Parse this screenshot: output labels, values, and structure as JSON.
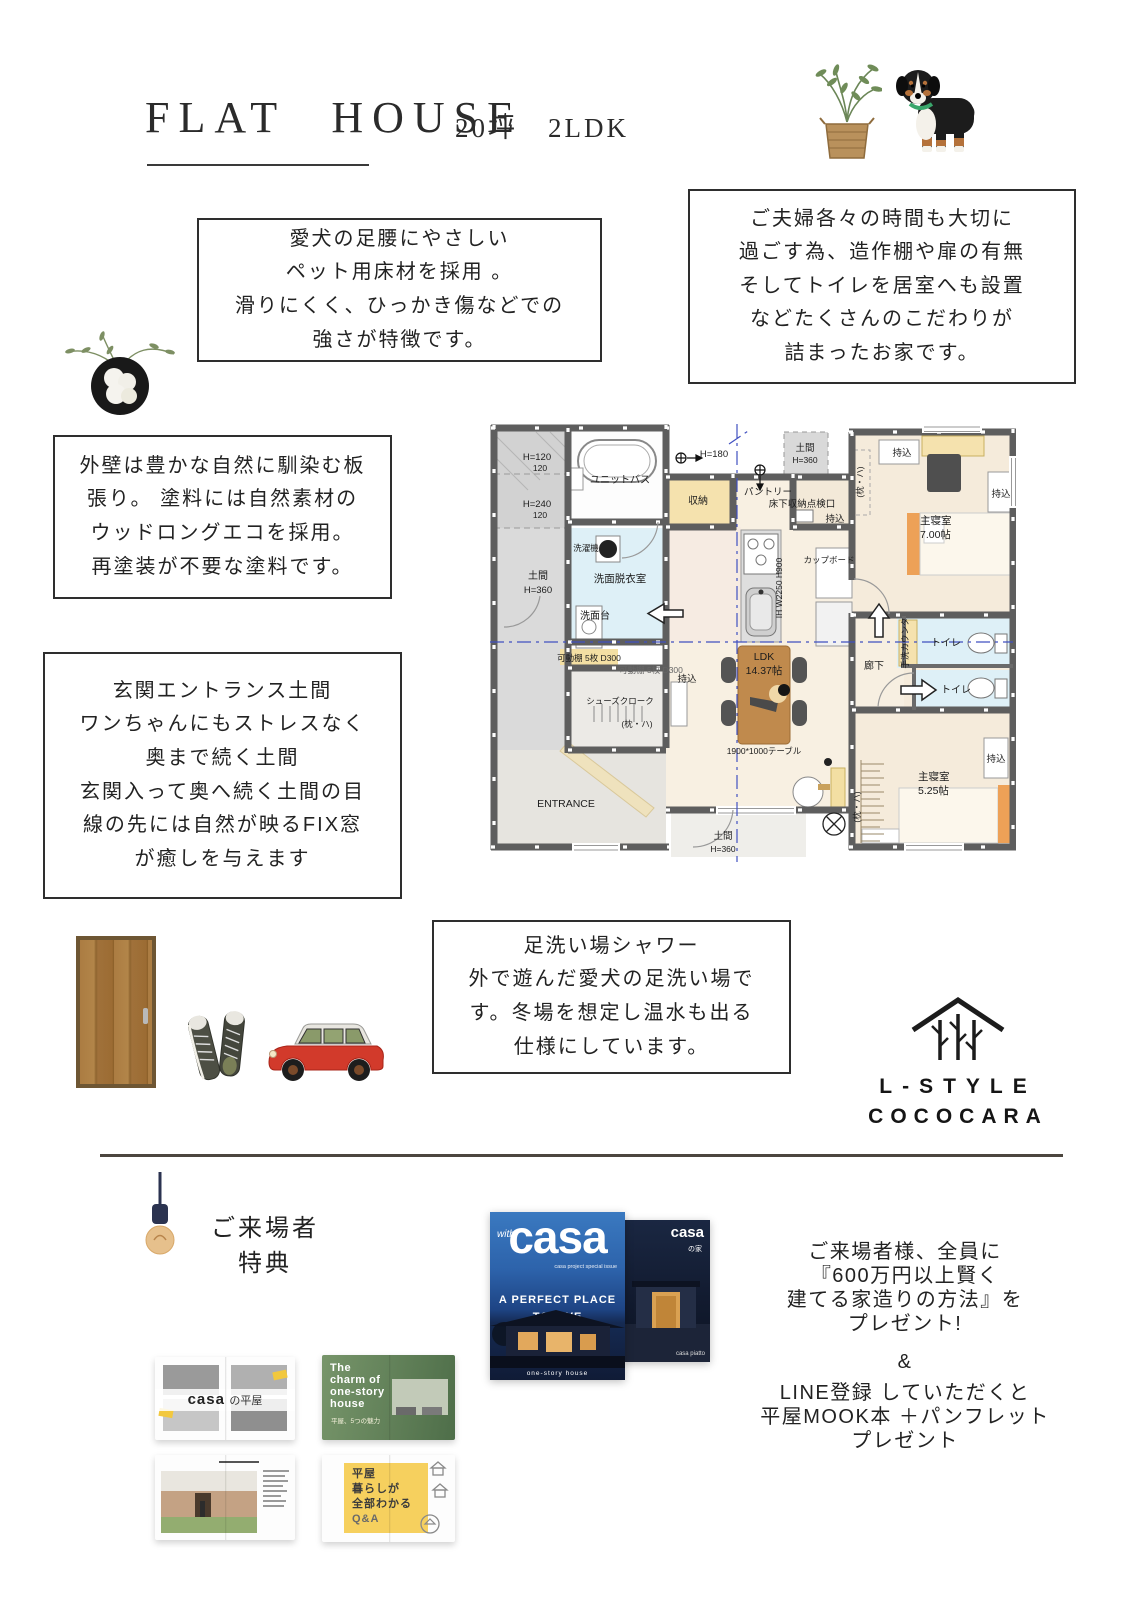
{
  "header": {
    "title": "FLAT HOUSE",
    "subtitle": "20坪　2LDK"
  },
  "boxes": {
    "pet": [
      "愛犬の足腰にやさしい",
      "ペット用床材を採用 。",
      "滑りにくく、ひっかき傷などでの",
      "強さが特徴です。"
    ],
    "couple": [
      "ご夫婦各々の時間も大切に",
      "過ごす為、造作棚や扉の有無",
      "そしてトイレを居室へも設置",
      "などたくさんのこだわりが",
      "詰まったお家です。"
    ],
    "wall": [
      "外壁は豊かな自然に馴染む板",
      "張り。 塗料には自然素材の",
      "ウッドロングエコを採用。",
      "再塗装が不要な塗料です。"
    ],
    "entrance": [
      "玄関エントランス土間",
      "ワンちゃんにもストレスなく",
      "奥まで続く土間",
      "玄関入って奥へ続く土間の目",
      "線の先には自然が映るFIX窓",
      "が癒しを与えます"
    ],
    "shower": [
      "足洗い場シャワー",
      "外で遊んだ愛犬の足洗い場で",
      "す。冬場を想定し温水も出る",
      "仕様にしています。"
    ]
  },
  "floorplan": {
    "labels": {
      "h120": "H=120",
      "sub120": "120",
      "h240": "H=240",
      "doma": "土間",
      "h360": "H=360",
      "h180": "H=180",
      "unit_bath": "ユニットバス",
      "shuno": "収納",
      "sentaku": "洗濯機",
      "senmen_room": "洗面脱衣室",
      "senmendai": "洗面台",
      "pantry": "パントリー",
      "yukashita": "床下収納点検口",
      "mochikomi": "持込",
      "cupboard": "カップボード",
      "ih": "IH W2250 H900",
      "kadodana": "可動棚 5枚 D300",
      "shoes": "シューズクローク",
      "makura": "(枕・ハ)",
      "ldk": "LDK",
      "ldk_size": "14.37帖",
      "table": "1900*1000テーブル",
      "entrance": "ENTRANCE",
      "rouka": "廊下",
      "tearai": "手洗カウンタ",
      "toilet": "トイレ",
      "bedroom": "主寝室",
      "bed1_size": "7.00帖",
      "bed2_size": "5.25帖"
    }
  },
  "logo": {
    "line1": "L-STYLE",
    "line2": "COCOCARA"
  },
  "benefit": {
    "heading1": "ご来場者",
    "heading2": "特典"
  },
  "covers": {
    "front": {
      "with": "with",
      "brand": "casa",
      "tagline": "casa project special issue",
      "line1": "A PERFECT PLACE",
      "line2": "TO LIVE",
      "footer": "one-story house"
    },
    "back": {
      "brand": "casa",
      "sub": "の家",
      "footer": "casa piatto"
    }
  },
  "spreads": {
    "tl": {
      "brand": "casa",
      "title": "の平屋"
    },
    "tr": {
      "l1": "The",
      "l2": "charm of",
      "l3": "one-story",
      "l4": "house",
      "sub": "平屋、5つの魅力"
    },
    "br": {
      "l1": "平屋",
      "l2": "暮らしが",
      "l3": "全部わかる",
      "l4": "Q&A"
    }
  },
  "promo": {
    "lines1": [
      "ご来場者様、全員に",
      "『600万円以上賢く",
      "建てる家造りの方法』を",
      "プレゼント!"
    ],
    "amp": "&",
    "lines2": [
      "LINE登録 していただくと",
      "平屋MOOK本 ＋パンフレット",
      "プレゼント"
    ]
  }
}
